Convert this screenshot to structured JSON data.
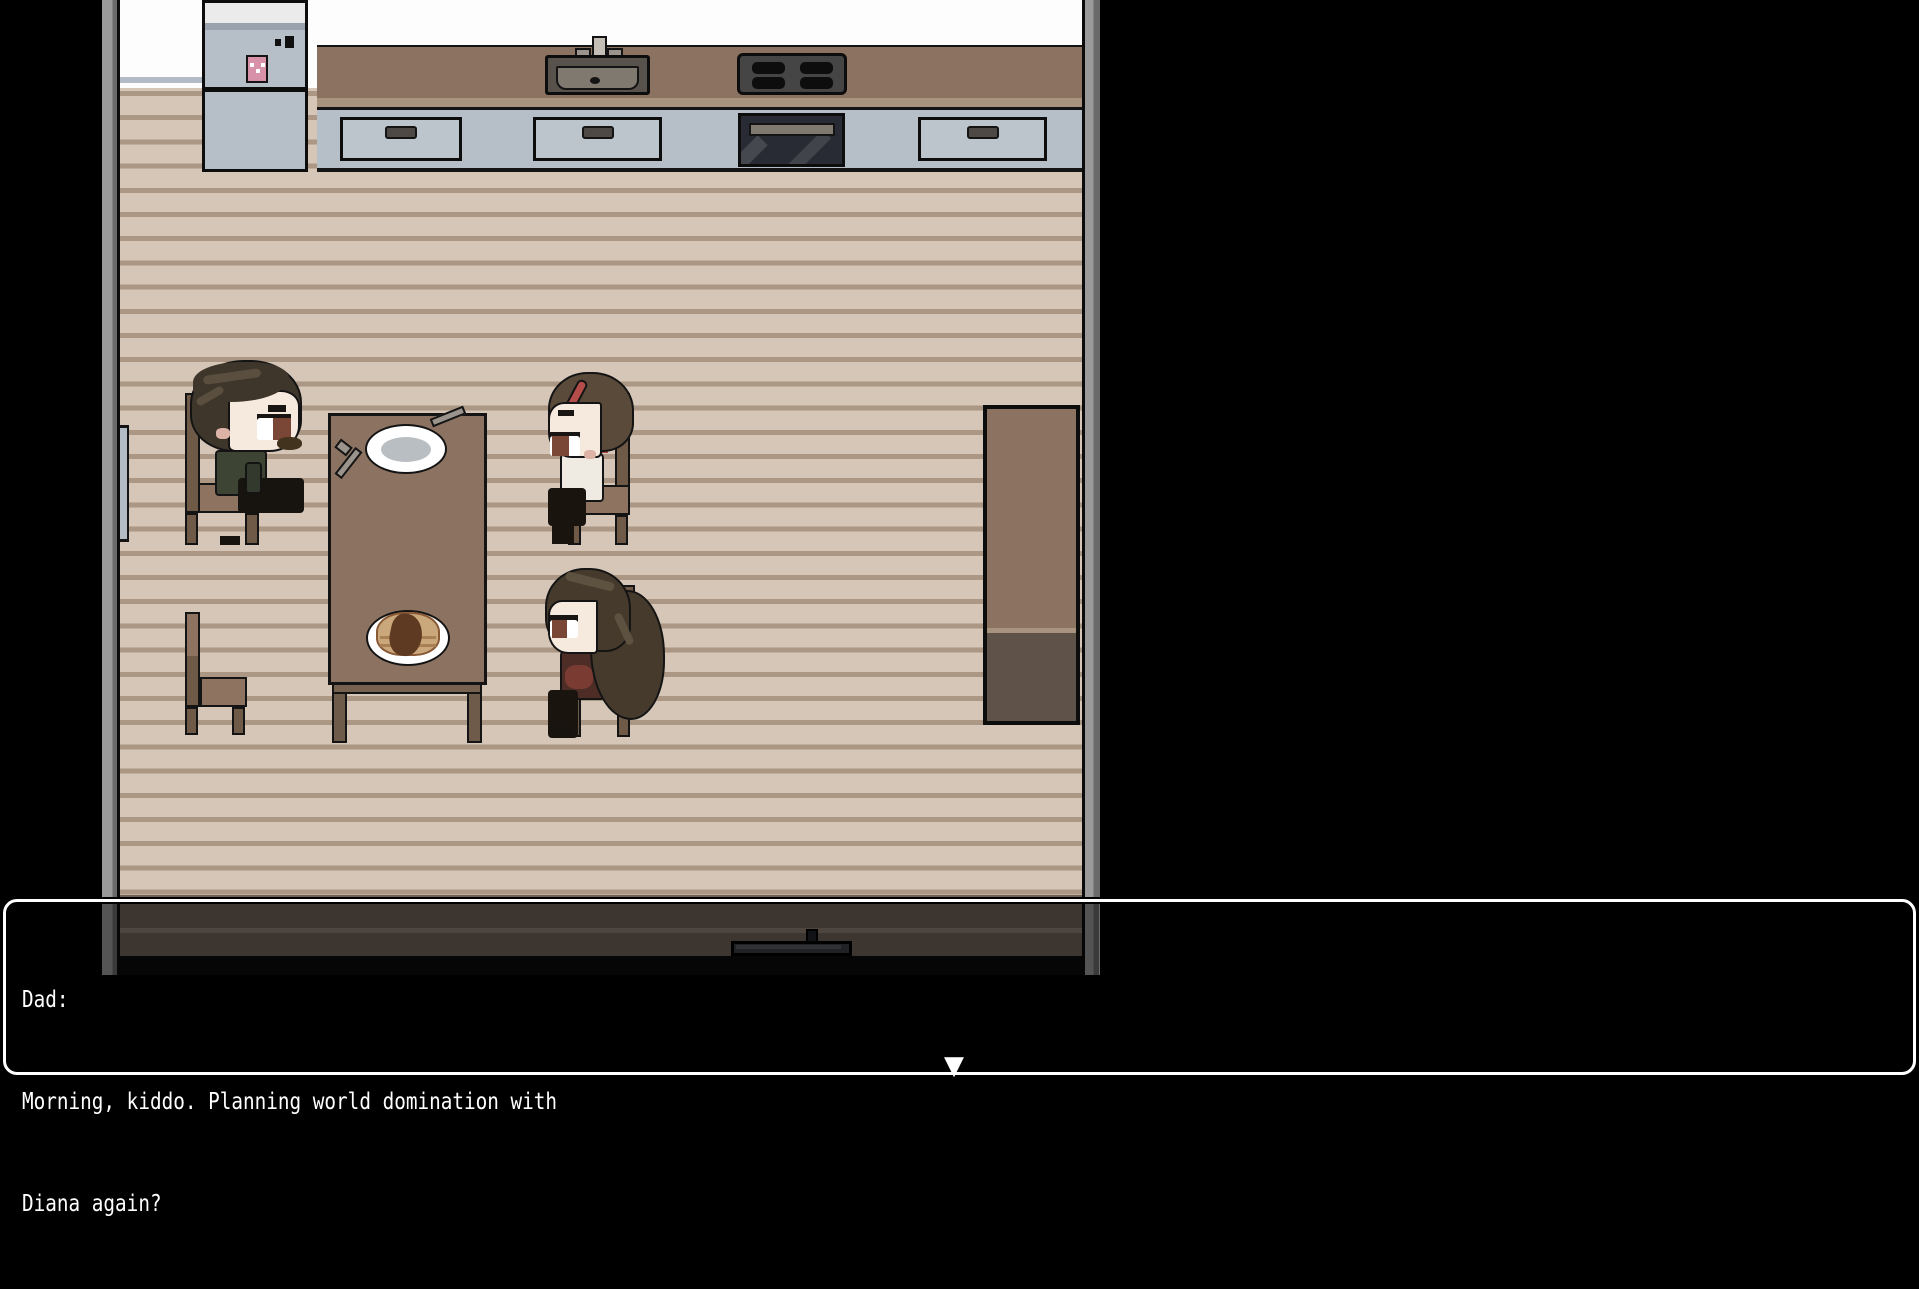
{
  "dialogue": {
    "speaker": "Dad:",
    "line1": "Morning, kiddo. Planning world domination with",
    "line2": "Diana again?",
    "continue_indicator": "▼"
  },
  "colors": {
    "background": "#000000",
    "dialog_border": "#ffffff",
    "dialog_text": "#ffffff",
    "canvas_border_gray": "#9a9a9a",
    "floor": "#d5c6b7",
    "floor_stripe": "#ab9783",
    "counter_brown": "#8c7260",
    "cabinet_gray": "#b6bec7",
    "bottom_wall": "#6f6156",
    "chair_wood": "#6f5a48",
    "chair_seat": "#8d7360",
    "skin": "#f6e9de",
    "dad_shirt": "#3d4434",
    "mom_top": "#efeae2",
    "mom_headband": "#b44c49",
    "daughter_top": "#4e2d27",
    "fridge_magnet_pink": "#d791a8"
  }
}
